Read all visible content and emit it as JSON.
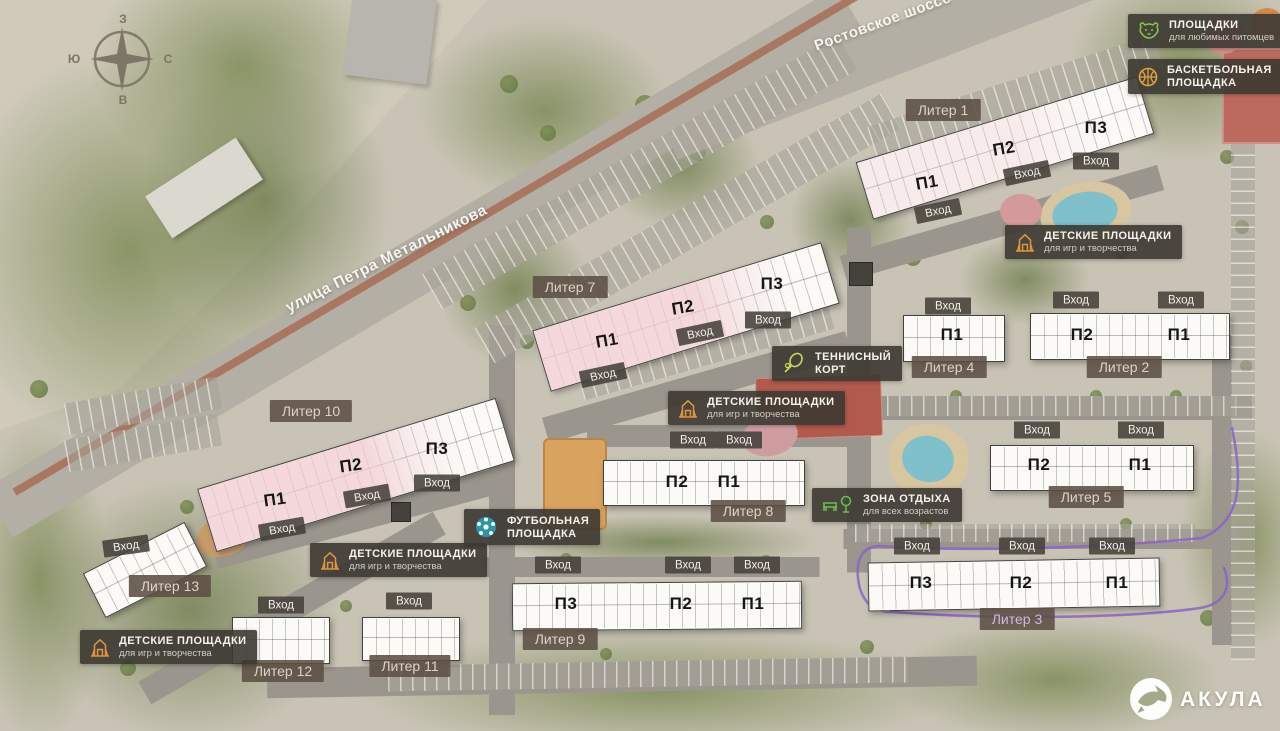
{
  "page_number": "16",
  "compass": {
    "top": "З",
    "right": "С",
    "bottom": "В",
    "left": "Ю"
  },
  "streets": {
    "main": "улица Петра Метальникова",
    "highway": "Ростовское шоссе"
  },
  "legend": {
    "pets": {
      "line1": "ПЛОЩАДКИ",
      "line2": "для любимых питомцев"
    },
    "basketball": {
      "line1": "БАСКЕТБОЛЬНАЯ",
      "line2": "ПЛОЩАДКА"
    }
  },
  "labels": {
    "kids": {
      "line1": "ДЕТСКИЕ ПЛОЩАДКИ",
      "line2": "для игр и творчества"
    },
    "tennis": {
      "line1": "ТЕННИСНЫЙ",
      "line2": "КОРТ"
    },
    "football": {
      "line1": "ФУТБОЛЬНАЯ",
      "line2": "ПЛОЩАДКА"
    },
    "rest": {
      "line1": "ЗОНА ОТДЫХА",
      "line2": "для всех возрастов"
    }
  },
  "entrance": "Вход",
  "sections": {
    "p1": "П1",
    "p2": "П2",
    "p3": "П3"
  },
  "buildings": {
    "l1": "Литер 1",
    "l2": "Литер 2",
    "l3": "Литер 3",
    "l4": "Литер 4",
    "l5": "Литер 5",
    "l7": "Литер 7",
    "l8": "Литер 8",
    "l9": "Литер 9",
    "l10": "Литер 10",
    "l11": "Литер 11",
    "l12": "Литер 12",
    "l13": "Литер 13"
  },
  "logo": "АКУЛА",
  "colors": {
    "map_base": "#c8c3b4",
    "building_pink": "#f1cbd1",
    "route_purple": "#8a63c9",
    "pets_icon": "#8bc34a",
    "basketball_icon": "#e2a33c",
    "kids_icon": "#e0953e",
    "tennis_icon": "#cbd65a",
    "football_icon": "#2e93a2",
    "rest_icon": "#69c04b",
    "badge_bg": "#3c3832",
    "liter_badge_bg": "#5c4f44"
  }
}
